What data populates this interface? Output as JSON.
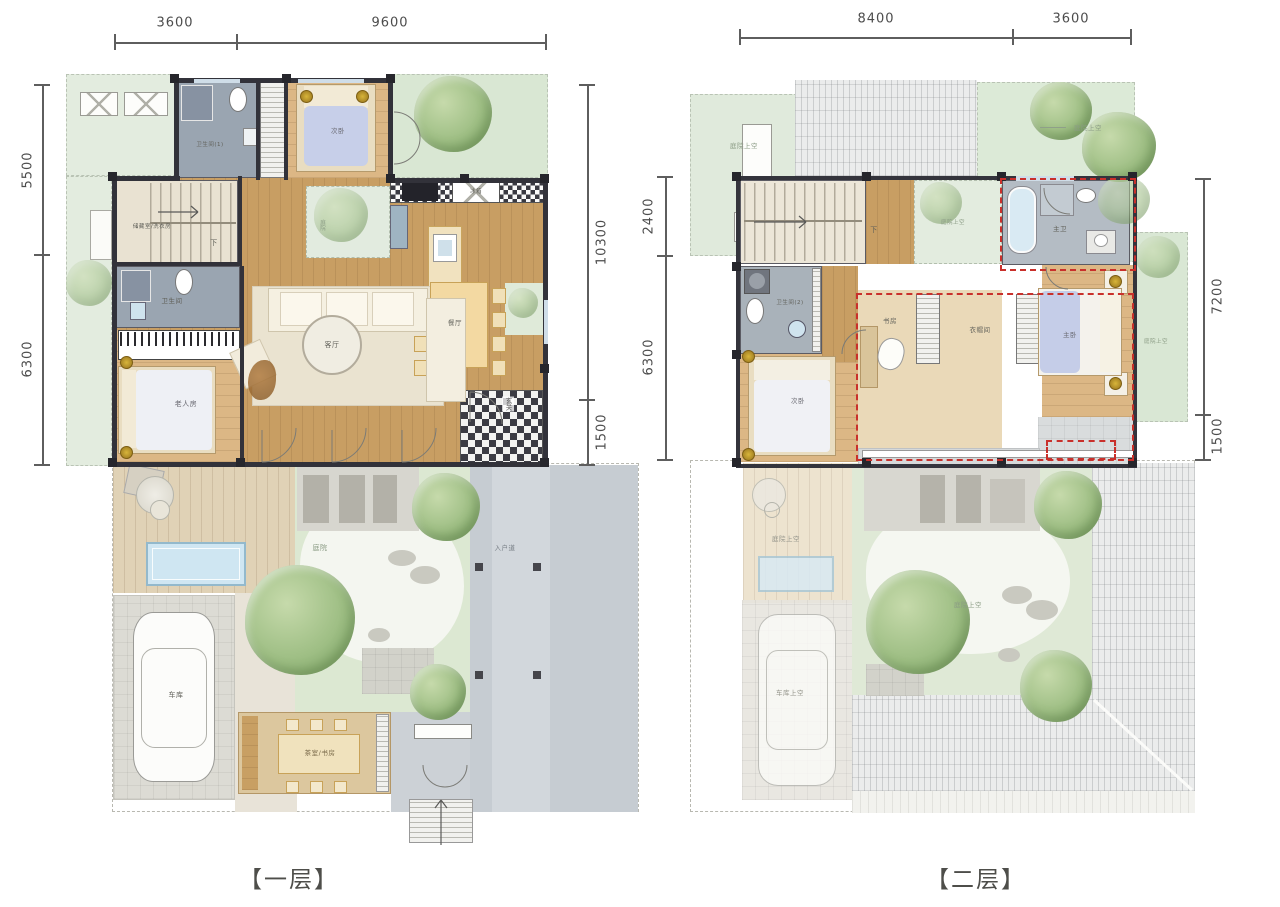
{
  "captions": {
    "floor1": "【一层】",
    "floor2": "【二层】"
  },
  "floor1": {
    "dims": {
      "top": [
        "3600",
        "9600"
      ],
      "left": [
        "5500",
        "6300"
      ],
      "right": [
        "10300",
        "1500"
      ]
    },
    "labels": {
      "bath1": "卫生间(1)",
      "bedroom2": "次卧",
      "storage": "储藏室/洗衣房",
      "stair_dir": "下",
      "bath": "卫生间",
      "elder_room": "老人房",
      "living": "客厅",
      "dining": "餐厅",
      "fridge": "冰箱",
      "inner_garden": "庭院",
      "foyer": "玄关",
      "garage": "车库",
      "courtyard": "庭院",
      "tea_study": "茶室/书房",
      "walkway": "入户道"
    }
  },
  "floor2": {
    "dims": {
      "top": [
        "8400",
        "3600"
      ],
      "left": [
        "2400",
        "6300"
      ],
      "right": [
        "7200",
        "1500"
      ]
    },
    "labels": {
      "garden_tl": "庭院上空",
      "garden_tr": "庭院上空",
      "stair_dir": "下",
      "inner_void": "庭院上空",
      "master_bath": "主卫",
      "bath2": "卫生间(2)",
      "bedroom2": "次卧",
      "study": "书房",
      "closet": "衣帽间",
      "master_bedroom": "主卧",
      "side_void": "庭院上空",
      "deck_void": "庭院上空",
      "garage_void": "车库上空",
      "courtyard_void": "庭院上空"
    }
  },
  "colors": {
    "wall": "#32323a",
    "wood_floor": "#c89e63",
    "bedroom_floor": "#dcb785",
    "bath_gray": "#9aa5b1",
    "garden_green": "#dcead7",
    "lawn": "#dfe9d6",
    "red_dashed": "#c9302b",
    "water": "#cfe6f2",
    "paving": "#c6ccd2",
    "deck": "#e0d2b6",
    "dim_line": "#5e5e5e"
  }
}
